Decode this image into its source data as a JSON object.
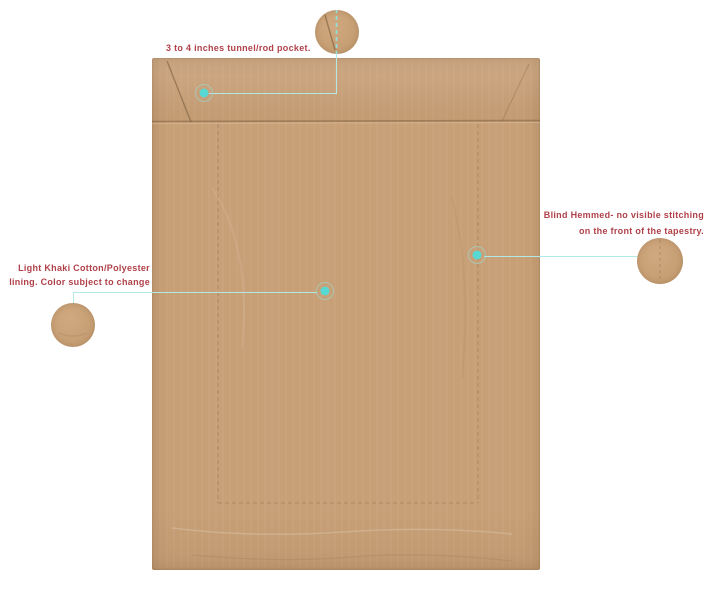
{
  "page": {
    "background": "#ffffff",
    "description": "Annotated product diagram of tapestry back view"
  },
  "colors": {
    "label_text": "#b04149",
    "leader_line": "#b2e9e7",
    "marker_dot": "#58d8d2",
    "fabric": "#c8a077",
    "fabric_seam": "#8a6a42"
  },
  "annotations": {
    "rod_pocket": {
      "label": "3 to 4 inches tunnel/rod pocket."
    },
    "blind_hem": {
      "label_line1": "Blind Hemmed- no visible stitching",
      "label_line2": "on the front of the tapestry."
    },
    "lining": {
      "label_line1": "Light Khaki Cotton/Polyester",
      "label_line2": "lining. Color subject to change"
    }
  }
}
